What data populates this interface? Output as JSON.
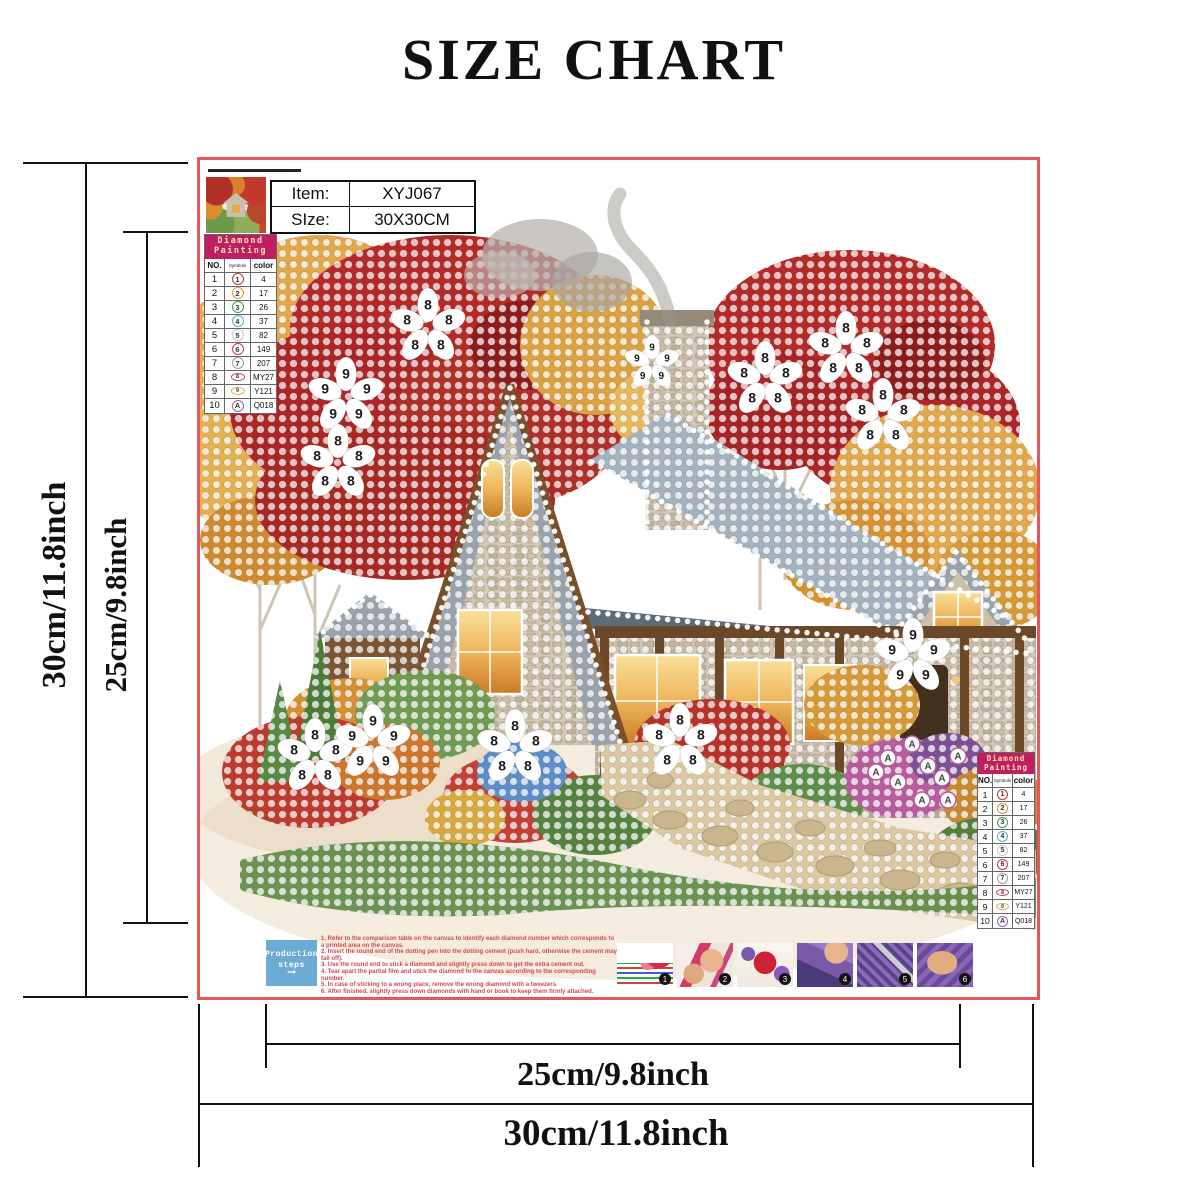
{
  "title": "SIZE CHART",
  "dimensions": {
    "left_outer": "30cm/11.8inch",
    "left_inner": "25cm/9.8inch",
    "bottom_inner": "25cm/9.8inch",
    "bottom_outer": "30cm/11.8inch"
  },
  "canvas": {
    "border_color": "#e8565c",
    "product": {
      "item_label": "Item:",
      "item_value": "XYJ067",
      "size_label": "SIze:",
      "size_value": "30X30CM"
    },
    "legend": {
      "title_line1": "Diamond",
      "title_line2": "Painting",
      "col_no": "NO.",
      "col_symbols": "Symbols",
      "col_color": "color",
      "rows": [
        {
          "no": "1",
          "sym": "1",
          "color_code": "4",
          "ring": "#b23a3a",
          "shape": "circle"
        },
        {
          "no": "2",
          "sym": "2",
          "color_code": "17",
          "ring": "#d89a3a",
          "shape": "circle"
        },
        {
          "no": "3",
          "sym": "3",
          "color_code": "26",
          "ring": "#3a9a4a",
          "shape": "circle"
        },
        {
          "no": "4",
          "sym": "4",
          "color_code": "37",
          "ring": "#4ab8c9",
          "shape": "circle"
        },
        {
          "no": "5",
          "sym": "5",
          "color_code": "82",
          "ring": "#c8c8c8",
          "shape": "circle"
        },
        {
          "no": "6",
          "sym": "6",
          "color_code": "149",
          "ring": "#c53a55",
          "shape": "circle"
        },
        {
          "no": "7",
          "sym": "7",
          "color_code": "207",
          "ring": "#9a9aa5",
          "shape": "circle"
        },
        {
          "no": "8",
          "sym": "8",
          "color_code": "MY27",
          "ring": "#cc4466",
          "shape": "oval"
        },
        {
          "no": "9",
          "sym": "9",
          "color_code": "Y121",
          "ring": "#d8b84a",
          "shape": "oval"
        },
        {
          "no": "10",
          "sym": "A",
          "color_code": "Q018",
          "ring": "#9a5ab8",
          "shape": "circle"
        }
      ]
    },
    "flowers": [
      {
        "x": 228,
        "y": 167,
        "label": "8"
      },
      {
        "x": 146,
        "y": 236,
        "label": "9"
      },
      {
        "x": 138,
        "y": 303,
        "label": "8"
      },
      {
        "x": 452,
        "y": 203,
        "label": "9",
        "small": true
      },
      {
        "x": 565,
        "y": 220,
        "label": "8"
      },
      {
        "x": 646,
        "y": 190,
        "label": "8"
      },
      {
        "x": 683,
        "y": 257,
        "label": "8"
      },
      {
        "x": 713,
        "y": 497,
        "label": "9"
      },
      {
        "x": 115,
        "y": 597,
        "label": "8"
      },
      {
        "x": 173,
        "y": 583,
        "label": "9"
      },
      {
        "x": 315,
        "y": 588,
        "label": "8"
      },
      {
        "x": 480,
        "y": 582,
        "label": "8"
      }
    ],
    "a_dots": {
      "label": "A",
      "ring": "#b85c9e",
      "points": [
        [
          688,
          598
        ],
        [
          712,
          584
        ],
        [
          728,
          606
        ],
        [
          698,
          622
        ],
        [
          742,
          618
        ],
        [
          758,
          596
        ],
        [
          676,
          612
        ],
        [
          722,
          640
        ],
        [
          748,
          640
        ]
      ]
    },
    "production": {
      "box_line1": "Production",
      "box_line2": "steps",
      "arrow": "⟶",
      "steps": [
        "1. Refer to the comparison table on the canvas to identify each diamond number which corresponds to a printed area on the canvas.",
        "2. Insert the round end of the dotting pen into the dotting cement (push hard, otherwise the cement may fall off).",
        "3. Use the round end to stick a diamond and slightly press down to get the extra cement out.",
        "4. Tear apart the partial film and stick the diamond to the canvas according to the corresponding number.",
        "5. In case of sticking to a wrong place, remove the wrong diamond with a tweezers.",
        "6. After finished, slightly press down diamonds with hand or book to keep them firmly attached."
      ],
      "photos": [
        "1",
        "2",
        "3",
        "4",
        "5",
        "6"
      ]
    }
  }
}
